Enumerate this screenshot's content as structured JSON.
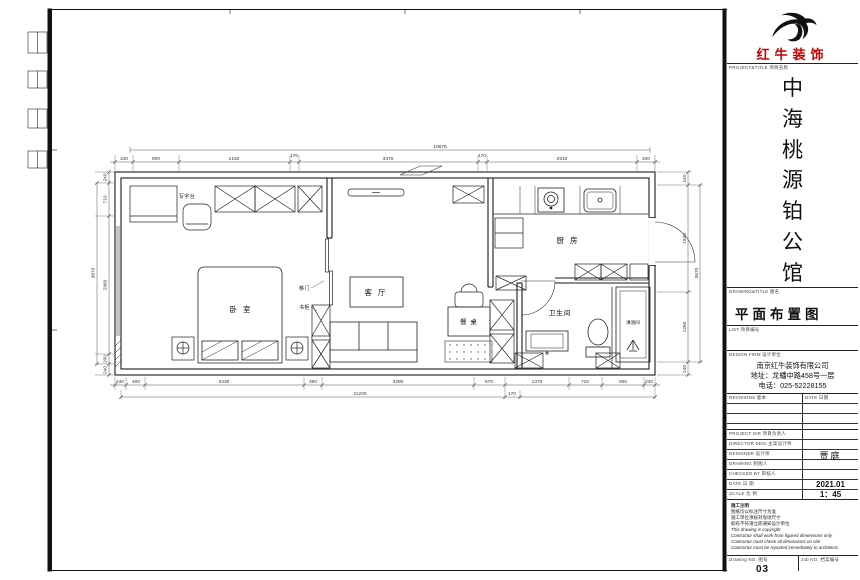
{
  "brand": {
    "name": "红牛装饰",
    "color": "#c40000",
    "logo_icon": "bull-swoosh-icon"
  },
  "title_block": {
    "project_label": "PROJECT&TITLE 项目名称",
    "project_name": "中海桃源铂公馆",
    "chars": [
      "中",
      "海",
      "桃",
      "源",
      "铂",
      "公",
      "馆"
    ],
    "drawing_label": "DRAWING&TITLE 图名",
    "drawing_title": "平面布置图",
    "list_label": "LIST 项目编号",
    "firm_label": "DESIGN FIRM 设计单位",
    "firm_name": "南京红牛装饰有限公司",
    "firm_address": "地址：龙蟠中路458号一层",
    "firm_phone": "电话：025-52228155",
    "revisions_label": "REVISIONS 版本",
    "revisions_date_label": "DATE 日期",
    "rows": {
      "project_dir": "PROJECT DIR 项目负责人",
      "director": "DIRECTOR DESI 主案设计师",
      "designer": "DESIGNER 设计师",
      "drawing": "DRAWING 制图人",
      "checked": "CHECKED BY 审核人",
      "date": "DATE 日 期",
      "scale": "SCALE 比 例"
    },
    "designer_value": "贾庭",
    "date_value": "2021.01",
    "scale_value": "1：45",
    "notes": [
      "施工注明",
      "图纸均以标注尺寸为准",
      "施工单位须核对现场尺寸",
      "如有不符请立即通知设计单位",
      "This drawing is copyright",
      "Contractor shall work from figured dimensions only",
      "Contractor must check all dimensions on site",
      "Contractor must be reported immediately to architects"
    ],
    "drawing_no_label": "Drawing NO. 图号",
    "drawing_no": "03",
    "job_no_label": "Job NO. 档案编号"
  },
  "plan": {
    "rooms": {
      "bedroom": "卧 室",
      "living": "客 厅",
      "dining": "餐 桌",
      "kitchen": "厨 房",
      "bath": "卫生间",
      "shower": "淋浴间",
      "desk": "写字台",
      "sliding_door": "移门",
      "bookcase": "书柜"
    },
    "dims": {
      "top_total": "10675",
      "top": [
        "340",
        "900",
        "2150",
        "170",
        "3470",
        "170",
        "2910",
        "340"
      ],
      "bottom": [
        "240",
        "400",
        "3430",
        "390",
        "3290",
        "670",
        "1370",
        "710",
        "900",
        "240"
      ],
      "bottom_total": "11230",
      "bottom_extra": "170",
      "left": [
        "240",
        "710",
        "2960",
        "200",
        "240"
      ],
      "left_total": "3870",
      "right": [
        "240",
        "1930",
        "1260",
        "240"
      ],
      "right_total": "3670"
    }
  }
}
